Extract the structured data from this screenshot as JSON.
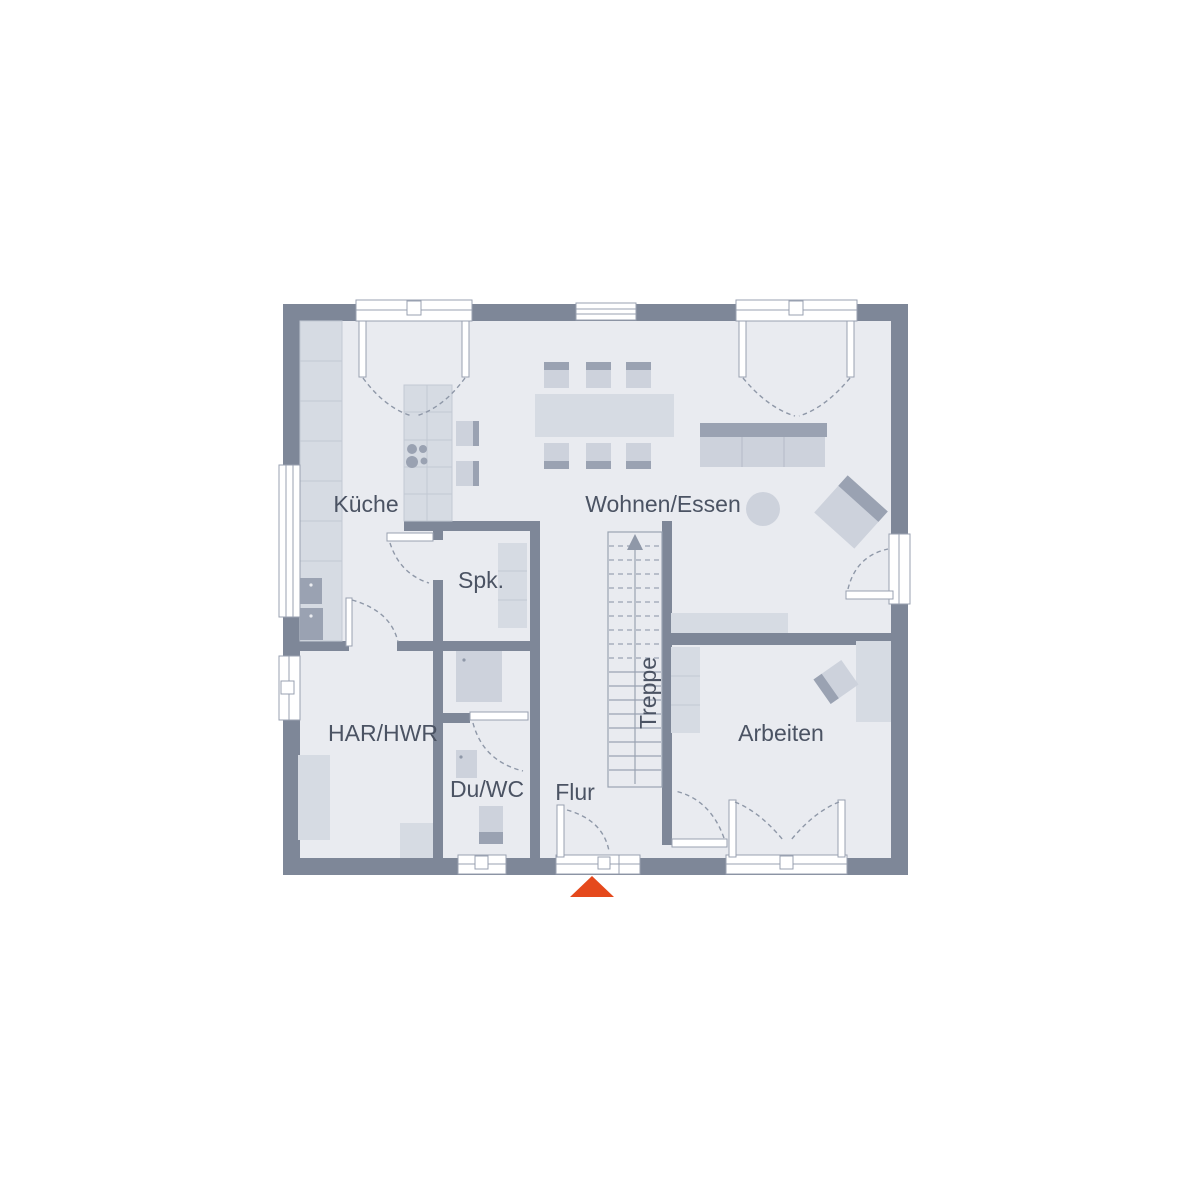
{
  "floorplan": {
    "rooms": {
      "kitchen": "Küche",
      "living": "Wohnen/Essen",
      "pantry": "Spk.",
      "utility": "HAR/HWR",
      "bath": "Du/WC",
      "hall": "Flur",
      "stairs": "Treppe",
      "office": "Arbeiten"
    },
    "colors": {
      "background": "#ffffff",
      "wall": "#7e8798",
      "floor": "#e9ebf0",
      "furniture_light": "#d6dbe3",
      "furniture_mid": "#cdd2dc",
      "furniture_dark": "#9aa2b2",
      "outline": "#99a1b1",
      "cell_line": "#c2c8d3",
      "stair_line": "#9aa3b2",
      "dash_line": "#8f98a8",
      "text": "#4b5363",
      "entrance_marker": "#e5491c"
    }
  }
}
